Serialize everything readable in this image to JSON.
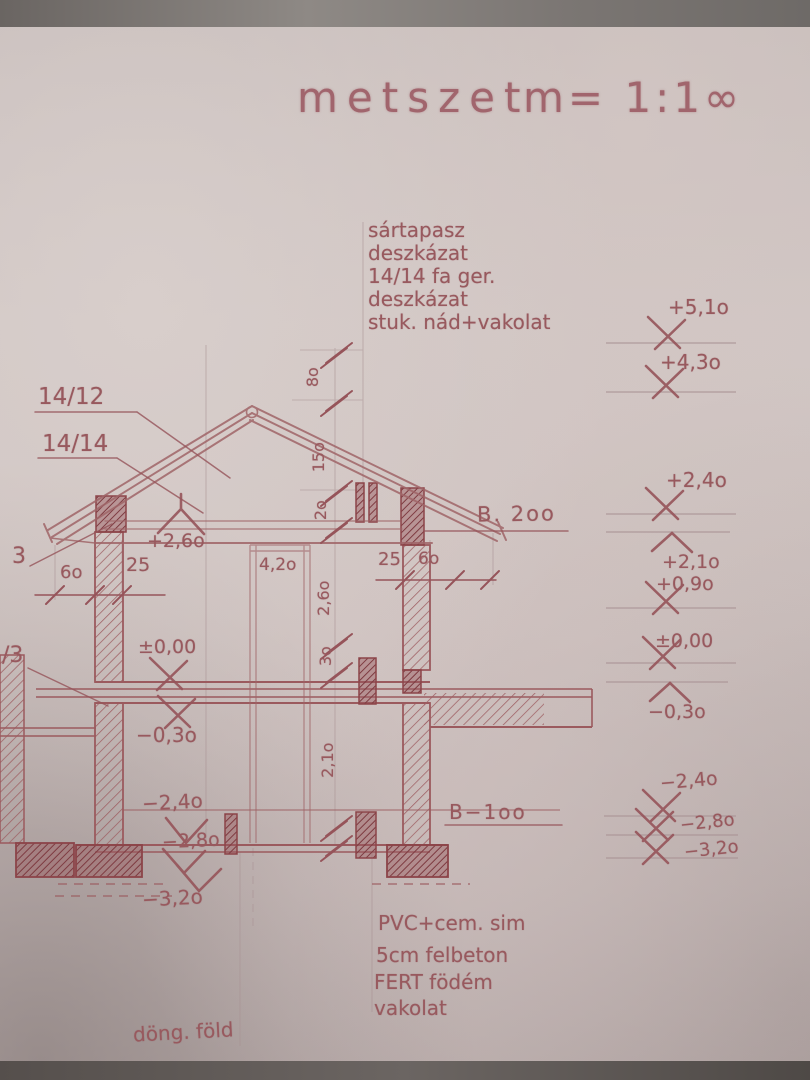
{
  "document": {
    "title_word": "metszet",
    "title_scale": "m= 1:1∞"
  },
  "notes": {
    "roof": [
      "sártapasz",
      "deszkázat",
      "14/14 fa ger.",
      "deszkázat",
      "stuk. nád+vakolat"
    ],
    "floor": [
      "PVC+cem. sim",
      "5cm felbeton",
      "FERT födém",
      "vakolat"
    ],
    "ground": "döng. föld"
  },
  "levels": {
    "right": [
      "+5,1o",
      "+4,3o",
      "+2,4o",
      "+2,1o",
      "+0,9o",
      "±0,00",
      "−0,3o",
      "−2,4o",
      "−2,8o",
      "−3,2o"
    ],
    "left": [
      "+2,6o",
      "±0,00",
      "−0,3o",
      "−2,4o",
      "−2,8o",
      "−3,2o"
    ]
  },
  "members": {
    "rafter": "14/12",
    "wall_plate": "14/14",
    "detail_upper": "3",
    "detail_lower": "/3"
  },
  "beams": {
    "upper": "B. 2oo",
    "lower": "B−1oo"
  },
  "dims": {
    "vertical_chain": [
      "8o",
      "15o",
      "2o",
      "2,6o",
      "3o",
      "2,1o"
    ],
    "left_horizontal": [
      "6o",
      "25"
    ],
    "right_horizontal": [
      "25",
      "6o"
    ],
    "opening_height": "4,2o"
  },
  "colors": {
    "ink": "#9a5a5f",
    "ink_dark": "#8c4449",
    "paper": "#cfc5c3"
  }
}
